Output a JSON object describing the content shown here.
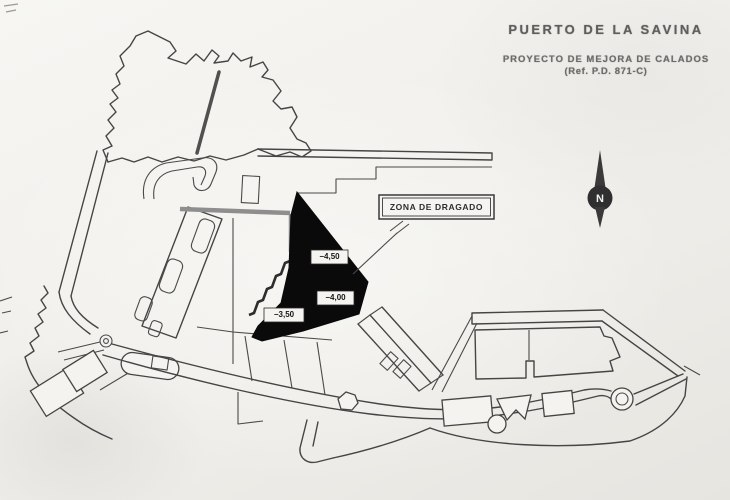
{
  "page": {
    "paper_color": "#f1efec",
    "ink_color": "#454545"
  },
  "title_block": {
    "title": "PUERTO DE LA SAVINA",
    "subtitle": "PROYECTO DE MEJORA DE CALADOS",
    "reference": "(Ref. P.D. 871-C)"
  },
  "plan": {
    "dredge_zone": {
      "label": "ZONA DE DRAGADO",
      "fill_color": "#0a0a0a",
      "depth_marks": [
        "−4,50",
        "−4,00",
        "−3,50"
      ]
    },
    "compass": {
      "label": "N"
    }
  }
}
